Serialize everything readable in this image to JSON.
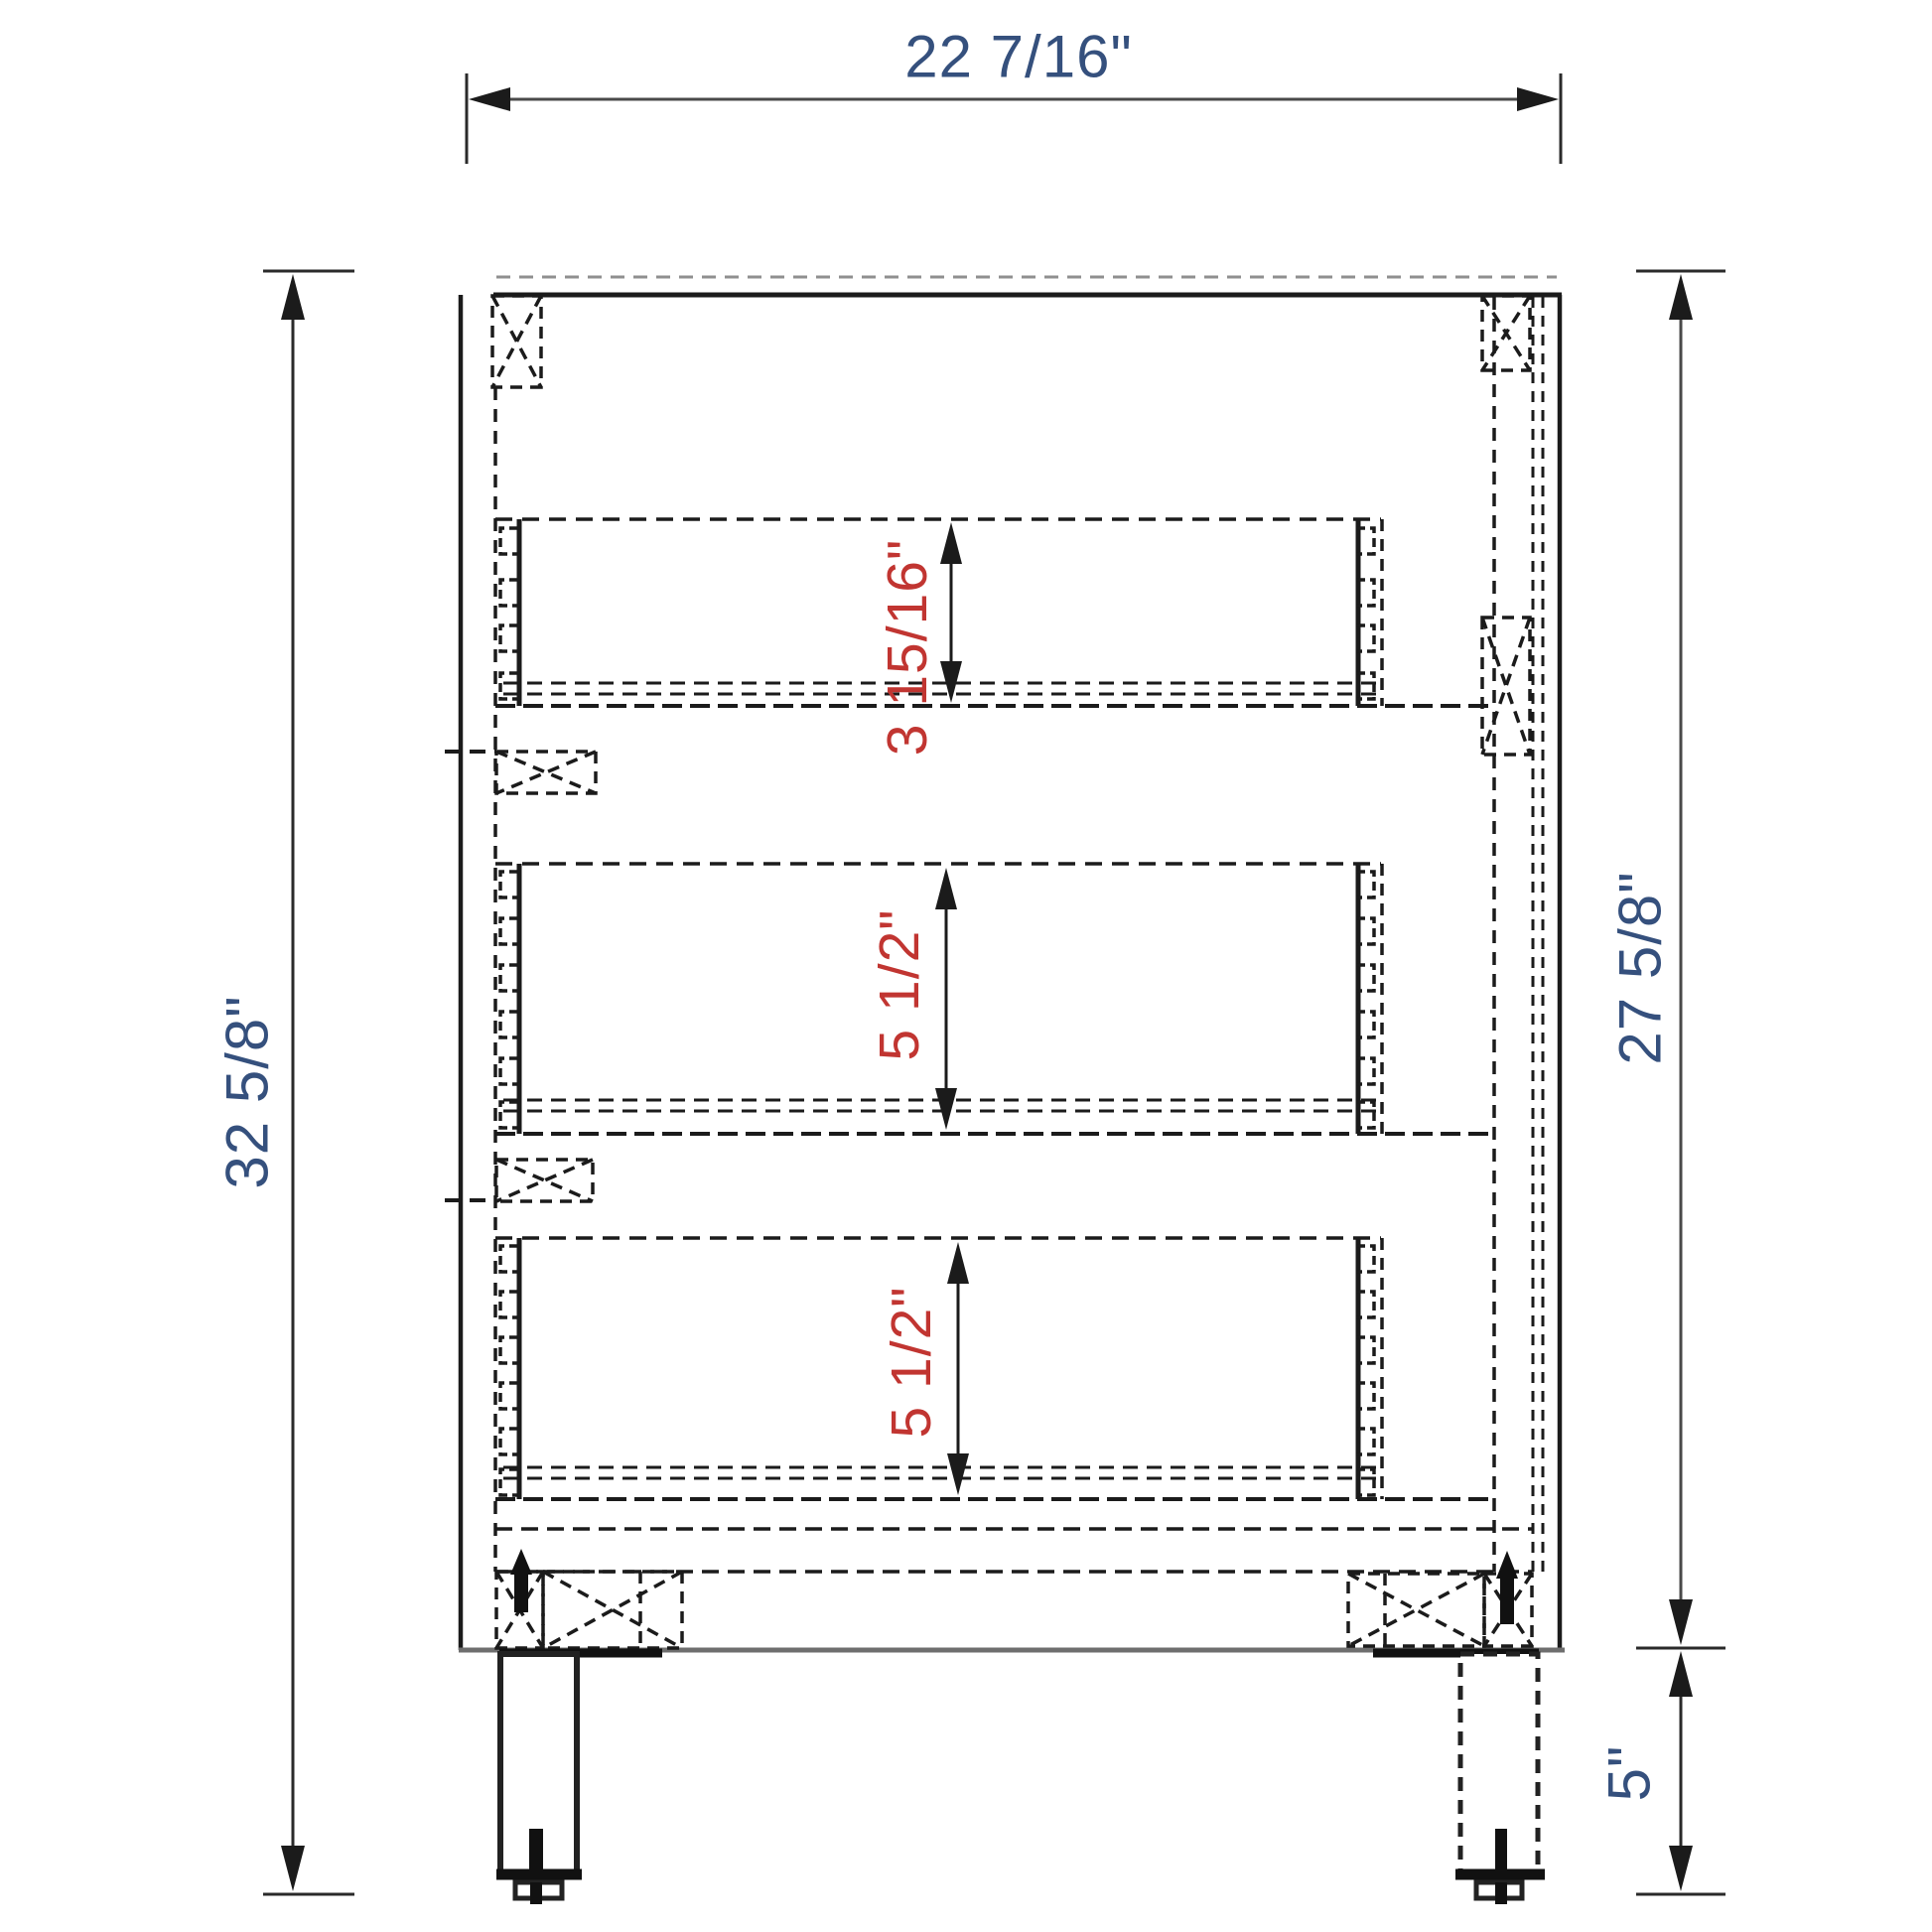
{
  "diagram": {
    "type": "cabinet-side-section-drawing",
    "unit": "inches",
    "colors": {
      "blue": "#35507d",
      "red": "#c13531",
      "ink": "#1b1b1b",
      "ground": "#6e6e6e"
    },
    "dimensions": {
      "overall_depth": "22 7/16\"",
      "overall_height": "32 5/8\"",
      "carcass_height": "27 5/8\"",
      "leg_height": "5\"",
      "drawer1_inner_depth": "3 15/16\"",
      "drawer2_inner_depth": "5 1/2\"",
      "drawer3_inner_depth": "5 1/2\""
    }
  }
}
